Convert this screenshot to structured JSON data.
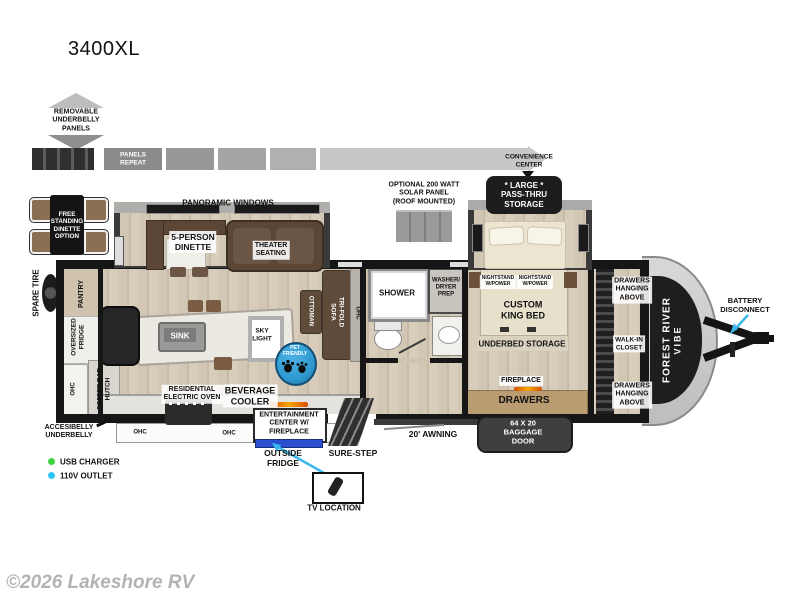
{
  "title": "3400XL",
  "watermark": "©2026 Lakeshore RV",
  "top": {
    "removable_underbelly": "REMOVABLE\nUNDERBELLY\nPANELS",
    "panels_repeat": "PANELS\nREPEAT",
    "convenience_center": "CONVENIENCE\nCENTER",
    "solar_panel": "OPTIONAL 200 WATT\nSOLAR PANEL\n(ROOF MOUNTED)",
    "pass_thru_storage": "* LARGE *\nPASS-THRU\nSTORAGE",
    "panoramic_windows": "PANORAMIC WINDOWS"
  },
  "exterior": {
    "spare_tire": "SPARE TIRE",
    "battery_disconnect": "BATTERY\nDISCONNECT",
    "brand_line1": "FOREST RIVER",
    "brand_line2": "VIBE",
    "awning": "20' AWNING",
    "baggage_door": "64 X 20\nBAGGAGE\nDOOR",
    "sure_step": "SURE-STEP",
    "outside_fridge": "OUTSIDE\nFRIDGE",
    "tv_location": "TV LOCATION",
    "accessibelly": "ACCESIBELLY\nUNDERBELLY",
    "free_standing_dinette": "FREE\nSTANDING\nDINETTE\nOPTION"
  },
  "interior": {
    "dinette": "5-PERSON\nDINETTE",
    "theater": "THEATER\nSEATING",
    "pantry": "PANTRY",
    "oversized_fridge": "OVERSIZED\nFRIDGE",
    "coffee_bar": "COFFEE BAR\nHUTCH",
    "ohc": "OHC",
    "sink": "SINK",
    "sky_light": "SKY\nLIGHT",
    "pet_friendly": "PET\nFRIENDLY",
    "ottoman": "OTTOMAN",
    "tri_fold_sofa": "TRI-FOLD\nSOFA",
    "oven": "RESIDENTIAL\nELECTRIC OVEN",
    "beverage_cooler": "BEVERAGE\nCOOLER",
    "entertainment": "ENTERTAINMENT\nCENTER W/\nFIREPLACE",
    "shower": "SHOWER",
    "washer_dryer": "WASHER/\nDRYER\nPREP",
    "nightstand_left": "NIGHTSTAND\nW/POWER",
    "nightstand_right": "NIGHTSTAND\nW/POWER",
    "king_bed": "CUSTOM\nKING BED",
    "underbed": "UNDERBED STORAGE",
    "fireplace": "FIREPLACE",
    "drawers": "DRAWERS",
    "drawers_above_top": "DRAWERS\nHANGING\nABOVE",
    "walk_in_closet": "WALK-IN\nCLOSET",
    "drawers_above_bottom": "DRAWERS\nHANGING\nABOVE"
  },
  "legend": {
    "usb": "USB CHARGER",
    "outlet": "110V OUTLET"
  },
  "colors": {
    "usb_dot": "#3fd23f",
    "outlet_dot": "#2bc6f3",
    "pet_circle": "#2f9ad1",
    "outside_fridge_bar": "#2b4fd0",
    "callout_arrow": "#38b8ec",
    "flame": "#e06000"
  }
}
